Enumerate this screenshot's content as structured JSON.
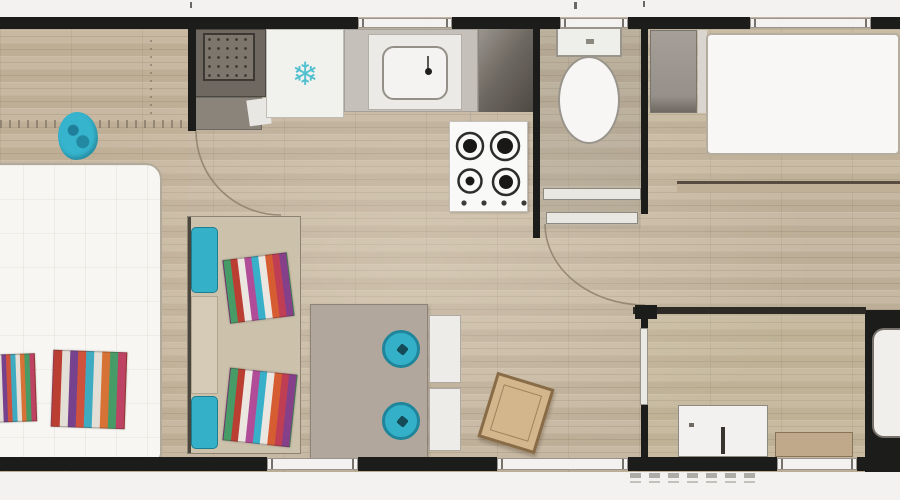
{
  "plan_kind": "mobile-home floor plan, top-down view, no text labels",
  "colors": {
    "wall": "#191917",
    "floor_wood": "#c6b69e",
    "accent_teal": "#2ab4cf",
    "accent_teal_dark": "#157f96",
    "bed_white": "#fbfaf6",
    "sofa_tan": "#cfc3ab",
    "table_gray": "#b4a89d",
    "stool_wood_seat": "#d9b789",
    "bench_tan": "#c2aa88",
    "counter_dark": "#6e675e",
    "snowflake_teal": "#49c4d4"
  },
  "icons": {
    "freezer_snowflake": "❄"
  },
  "palettes": {
    "pillow_stripes_sofa": [
      "#3f9e63",
      "#c43a2e",
      "#efe9e1",
      "#b8489e",
      "#2fb3cf",
      "#efe9e1",
      "#e05a2b",
      "#c93a52",
      "#8a3c8f"
    ],
    "pillow_stripes_bed": [
      "#c43a2e",
      "#e8e2d8",
      "#7a3f92",
      "#d94f36",
      "#35aec6",
      "#e8e2d8",
      "#e0702e",
      "#3f9e63",
      "#c73e62"
    ]
  },
  "counts": {
    "hob_burners": 4,
    "hob_knobs": 4,
    "top_windows": 3,
    "bottom_windows": 3,
    "entry_step_marks": 7,
    "striped_pillows": 4,
    "teal_stools": 2
  },
  "legend": [
    "master-bed",
    "striped-pillows",
    "teal-beanbag",
    "sofa-with-teal-armrests",
    "dining-table",
    "teal-stools",
    "white-dining-chairs",
    "wooden-stool",
    "dark-counter-unit",
    "fridge-freezer",
    "kitchen-sink",
    "glass-panel",
    "gas-hob-4-burner",
    "toilet",
    "wardrobe",
    "single-bed-top-right",
    "dresser",
    "storage-bench",
    "bed-niche",
    "door-swing-arcs",
    "entry-steps"
  ]
}
